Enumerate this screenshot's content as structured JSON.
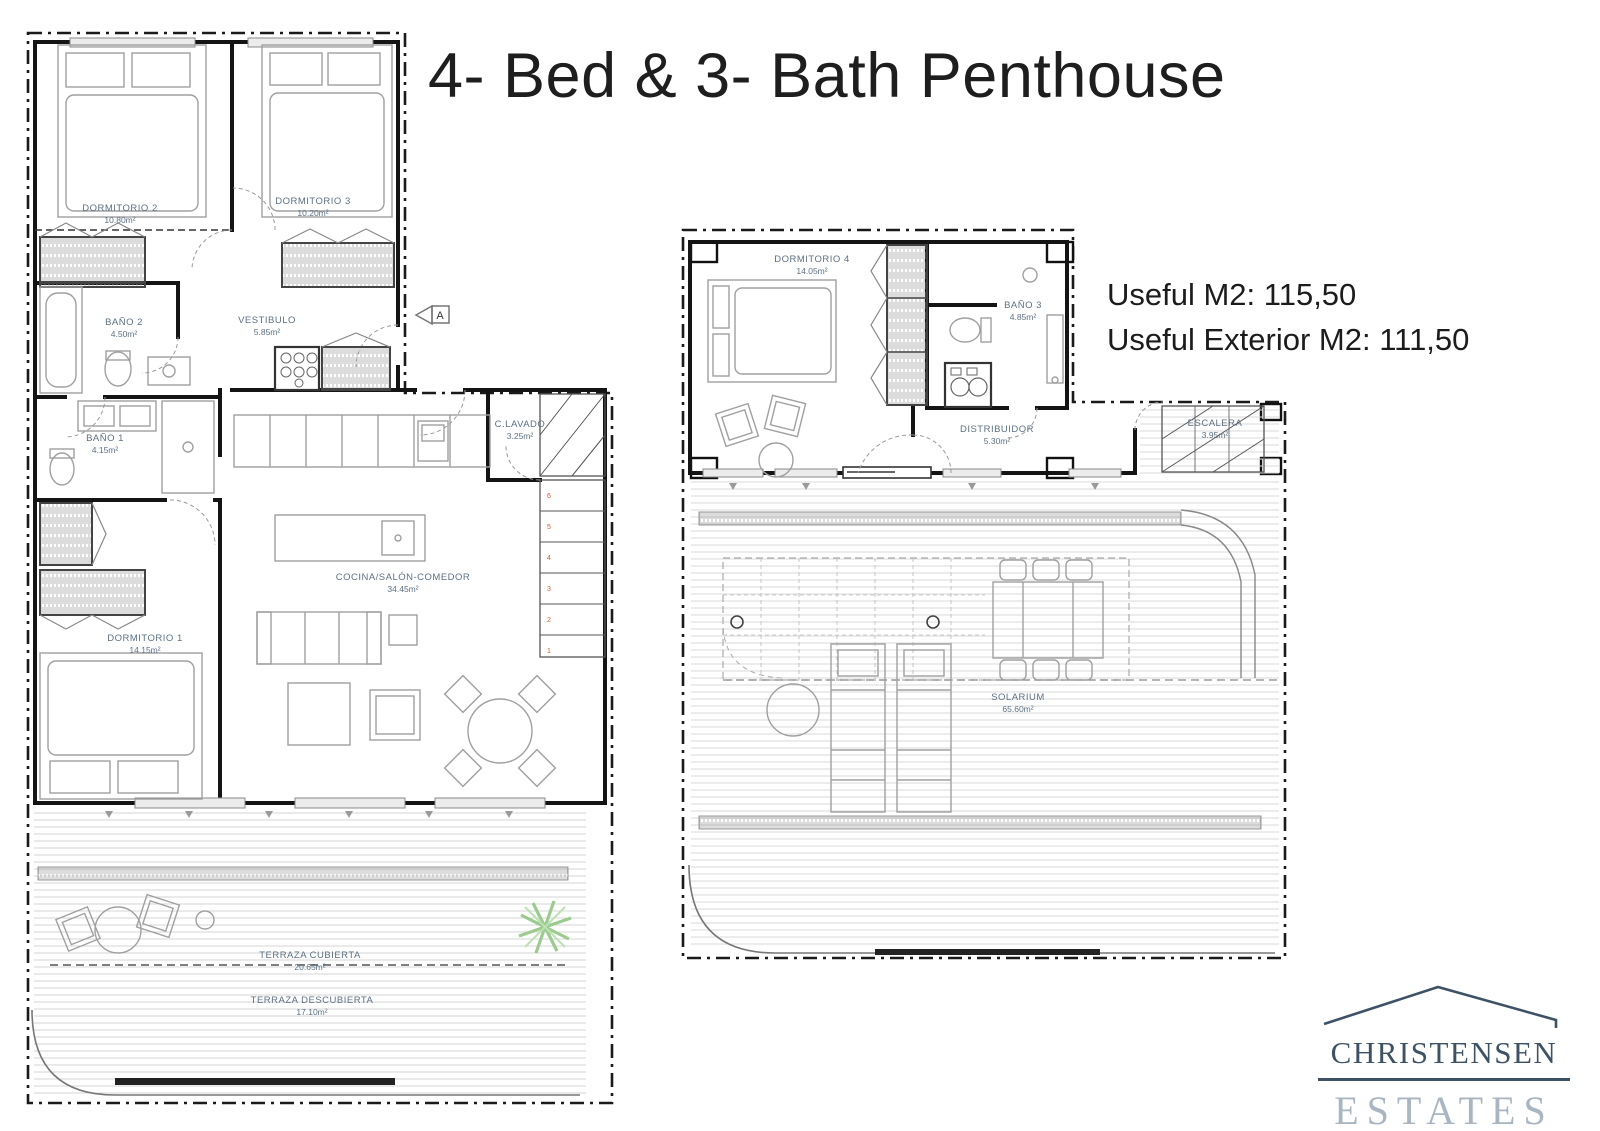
{
  "title": "4- Bed & 3- Bath Penthouse",
  "info": {
    "useful": "Useful M2: 115,50",
    "useful_exterior": "Useful Exterior M2: 111,50"
  },
  "logo": {
    "name": "CHRISTENSEN",
    "type": "ESTATES"
  },
  "colors": {
    "room_label": "#5d7183",
    "logo_primary": "#3e5265",
    "logo_secondary": "#a9b5c1",
    "stair_number": "#cf5a32",
    "plant": "#9ccb8f"
  },
  "floor1": {
    "entrance_marker": "A",
    "stairs": [
      "1",
      "2",
      "3",
      "4",
      "5",
      "6"
    ],
    "rooms": {
      "dormitorio2": {
        "label": "DORMITORIO 2",
        "area": "10.80m²"
      },
      "dormitorio3": {
        "label": "DORMITORIO 3",
        "area": "10.20m²"
      },
      "bano2": {
        "label": "BAÑO 2",
        "area": "4.50m²"
      },
      "vestibulo": {
        "label": "VESTIBULO",
        "area": "5.85m²"
      },
      "bano1": {
        "label": "BAÑO 1",
        "area": "4.15m²"
      },
      "dormitorio1": {
        "label": "DORMITORIO 1",
        "area": "14.15m²"
      },
      "cocina": {
        "label": "COCINA/SALÓN-COMEDOR",
        "area": "34.45m²"
      },
      "lavado": {
        "label": "C.LAVADO",
        "area": "3.25m²"
      },
      "terraza_cubierta": {
        "label": "TERRAZA CUBIERTA",
        "area": "20.65m²"
      },
      "terraza_descubierta": {
        "label": "TERRAZA DESCUBIERTA",
        "area": "17.10m²"
      }
    }
  },
  "floor2": {
    "rooms": {
      "dormitorio4": {
        "label": "DORMITORIO 4",
        "area": "14.05m²"
      },
      "bano3": {
        "label": "BAÑO 3",
        "area": "4.85m²"
      },
      "distribuidor": {
        "label": "DISTRIBUIDOR",
        "area": "5.30m²"
      },
      "escalera": {
        "label": "ESCALERA",
        "area": "3.95m²"
      },
      "solarium": {
        "label": "SOLARIUM",
        "area": "65.60m²"
      }
    }
  }
}
